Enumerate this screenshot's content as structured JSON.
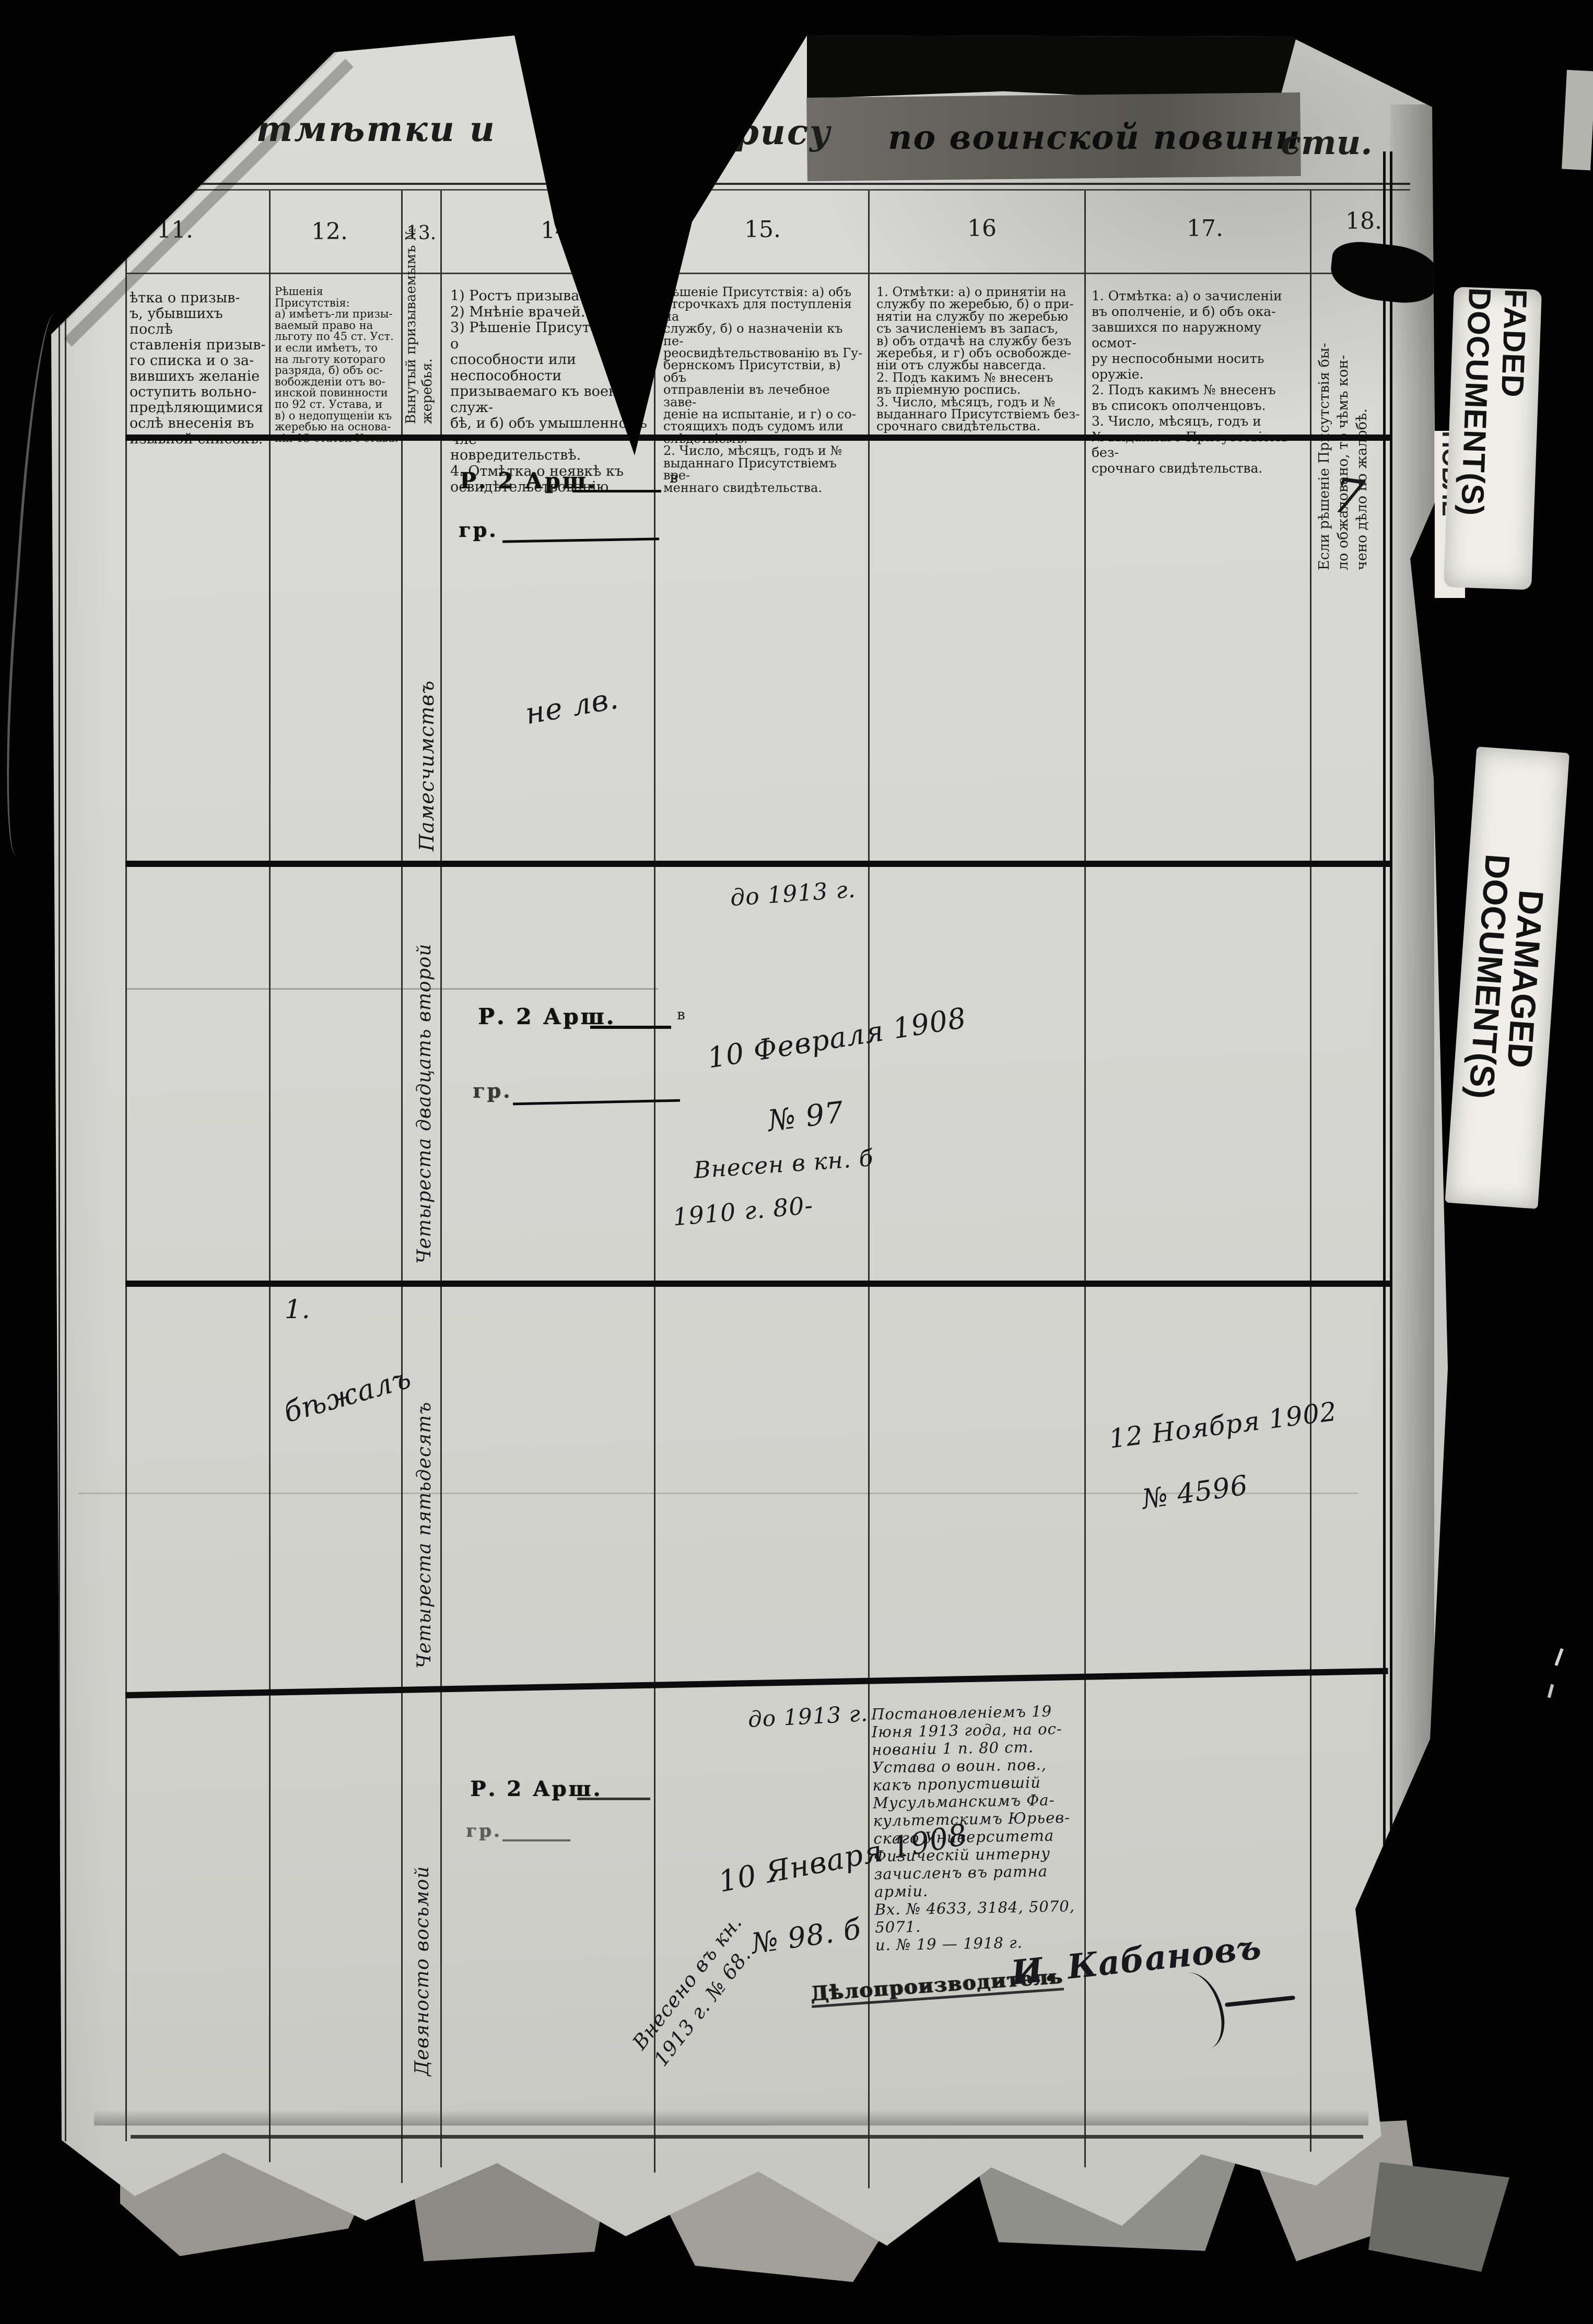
{
  "title": {
    "seg1": "Отмѣтки и",
    "seg2": "нія прису",
    "seg3": "по воинской повинн",
    "seg4": "сти."
  },
  "page_number": "7",
  "stickers": {
    "faded": "FADED DOCUMENT(S)",
    "faded_under": "ПОБЛЕ",
    "damaged_line1": "DAMAGED",
    "damaged_line2": "DOCUMENT(S)"
  },
  "columns": {
    "c11": {
      "number": "11.",
      "header": "ѣтка о призыв-\nъ, убывшихъ послѣ\nставленія призыв-\nго списка и о за-\nвившихъ желаніе\nоступить вольно-\nпредѣляющимися\nослѣ внесенія въ\nизывной списокъ."
    },
    "c12": {
      "number": "12.",
      "header": "Рѣшенія Присутствія:\nа) имѣетъ-ли призы-\nваемый право на\nльготу по 45 ст. Уст.\nи если имѣетъ, то\nна льготу котораго\nразряда, б) объ ос-\nвобожденіи отъ во-\nинской повинности\nпо 92 ст. Устава, и\nв) о недопущеніи къ\nжеребью на основа-\nніи 13 статьи Устава."
    },
    "c13": {
      "number": "13.",
      "header": "Вынутый призываемымъ №\nжеребья."
    },
    "c14": {
      "number": "14.",
      "header": "1) Ростъ призываемаго.\n2) Мнѣніе врачей.\n3) Рѣшеніе Присутствія: а) о\nспособности или неспособности\nпризываемаго къ военной служ-\nбѣ, и б) объ умышленномъ чле-\nновредительствѣ.\n4. Отмѣтка о неявкѣ къ\nосвидѣтельствованію."
    },
    "c15": {
      "number": "15.",
      "header": "Рѣшеніе Присутствія: а) объ\nотсрочкахъ для поступленія на\nслужбу, б) о назначеніи къ пе-\nреосвидѣтельствованію въ Гу-\nбернскомъ Присутствіи, в) объ\nотправленіи въ лечебное заве-\nденіе на испытаніе, и г) о со-\nстоящихъ подъ судомъ или\nслѣдствіемъ.\n2. Число, мѣсяцъ, годъ и №\nвыданнаго Присутствіемъ вре-\nменнаго свидѣтельства."
    },
    "c16": {
      "number": "16",
      "header": "1. Отмѣтки: а) о принятіи на\nслужбу по жеребью, б) о при-\nнятіи на службу по жеребью\nсъ зачисленіемъ въ запасъ,\nв) объ отдачѣ на службу безъ\nжеребья, и г) объ освобожде-\nніи отъ службы навсегда.\n2. Подъ какимъ № внесенъ\nвъ пріемную роспись.\n3. Число, мѣсяцъ, годъ и №\nвыданнаго Присутствіемъ без-\nсрочнаго свидѣтельства."
    },
    "c17": {
      "number": "17.",
      "header": "1. Отмѣтка: а) о зачисленіи\nвъ ополченіе, и б) объ ока-\nзавшихся по наружному осмот-\nру неспособными носить оружіе.\n2. Подъ какимъ № внесенъ\nвъ списокъ ополченцовъ.\n3. Число, мѣсяцъ, годъ и\n№ выданнаго Присутствіемъ без-\nсрочнаго свидѣтельства."
    },
    "c18": {
      "number": "18.",
      "header": "Если рѣшеніе Присутствія бы-\nло обжаловано, то чѣмъ кон-\nчено дѣло по жалобѣ."
    }
  },
  "entries": {
    "row1": {
      "lot_number": "Памесчимствъ",
      "height": "Р. 2 Арш.",
      "height_suffix": "в",
      "gr": "гр.",
      "note": "не лв."
    },
    "row2": {
      "lot_number": "Четыреста двадцать второй",
      "height": "Р. 2 Арш.",
      "height_suffix": "в",
      "gr": "гр.",
      "until": "до 1913 г.",
      "date": "10 Февраля 1908",
      "number": "№ 97",
      "entered": "Внесен в кн. б",
      "entered2": "1910 г. 80-"
    },
    "row3": {
      "mark": "1.",
      "note": "бѣжалъ",
      "lot_number": "Четыреста пятьдесятъ",
      "date": "12 Ноября 1902",
      "number": "№ 4596"
    },
    "row4": {
      "lot_number": "Девяносто восьмой",
      "height": "Р. 2 Арш.",
      "gr": "гр.",
      "until": "до 1913 г.",
      "date": "10 Января 1908",
      "number": "№ 98. б",
      "entered_diagonal": "Внесено въ кн.\n1913 г. № 68.",
      "resolution": "Постановленіемъ 19\nІюня 1913 года, на ос-\nнованіи 1 п. 80 ст.\nУстава о воин. пов.,\nкакъ пропустившій\nМусульманскимъ Фа-\nкультетскимъ Юрьев-\nскаго Университета\nФизическій интерну\nзачисленъ въ ратна\nарміи.\nВх. № 4633, 3184, 5070,\n5071.\nи. № 19 — 1918 г.",
      "clerk_title": "Дѣлопроизводитель",
      "signature": "И. Кабановъ"
    }
  }
}
